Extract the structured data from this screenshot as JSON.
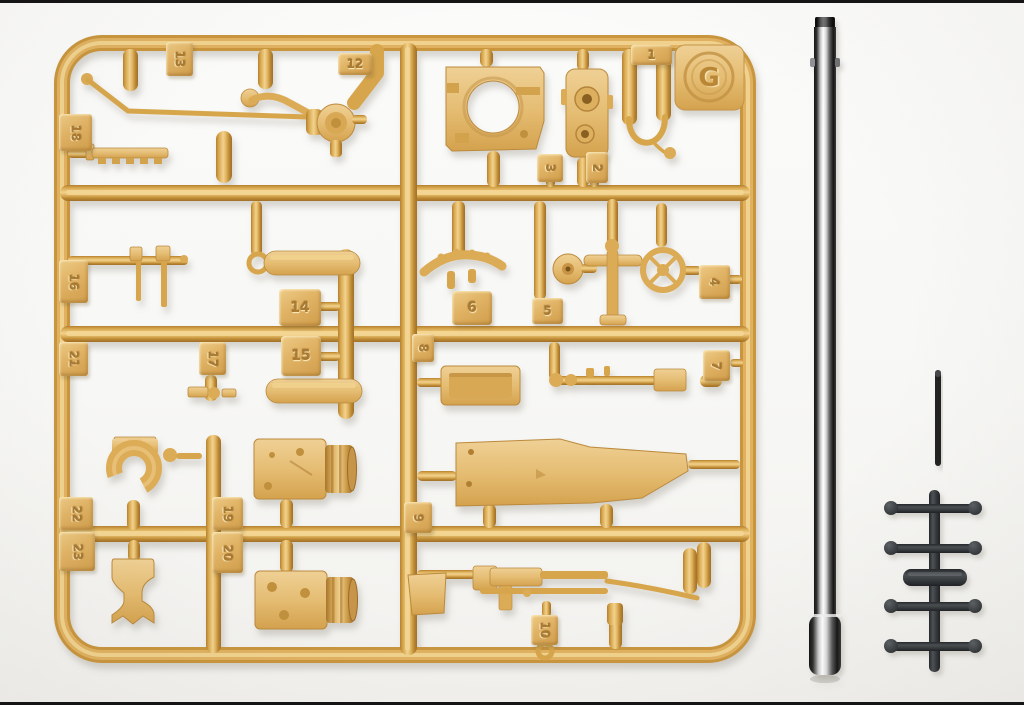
{
  "photo": {
    "background_color": "#f8f8f6",
    "edge_border_color": "#151515"
  },
  "sprue_g": {
    "emblem_letter": "G",
    "plastic_color": "#d9a64e",
    "plastic_highlight": "#f2d694",
    "plastic_shadow": "#a9762c",
    "part_numbers": [
      "13",
      "12",
      "1",
      "3",
      "2",
      "18",
      "16",
      "21",
      "22",
      "23",
      "14",
      "15",
      "17",
      "19",
      "20",
      "8",
      "9",
      "10",
      "5",
      "6",
      "4",
      "7"
    ]
  },
  "metal_barrel": {
    "highlight_color": "#ffffff",
    "dark_color": "#141414"
  },
  "metal_rod": {
    "color": "#212224"
  },
  "black_sprue": {
    "plastic_color": "#3a3e41",
    "ball_count": 8
  }
}
